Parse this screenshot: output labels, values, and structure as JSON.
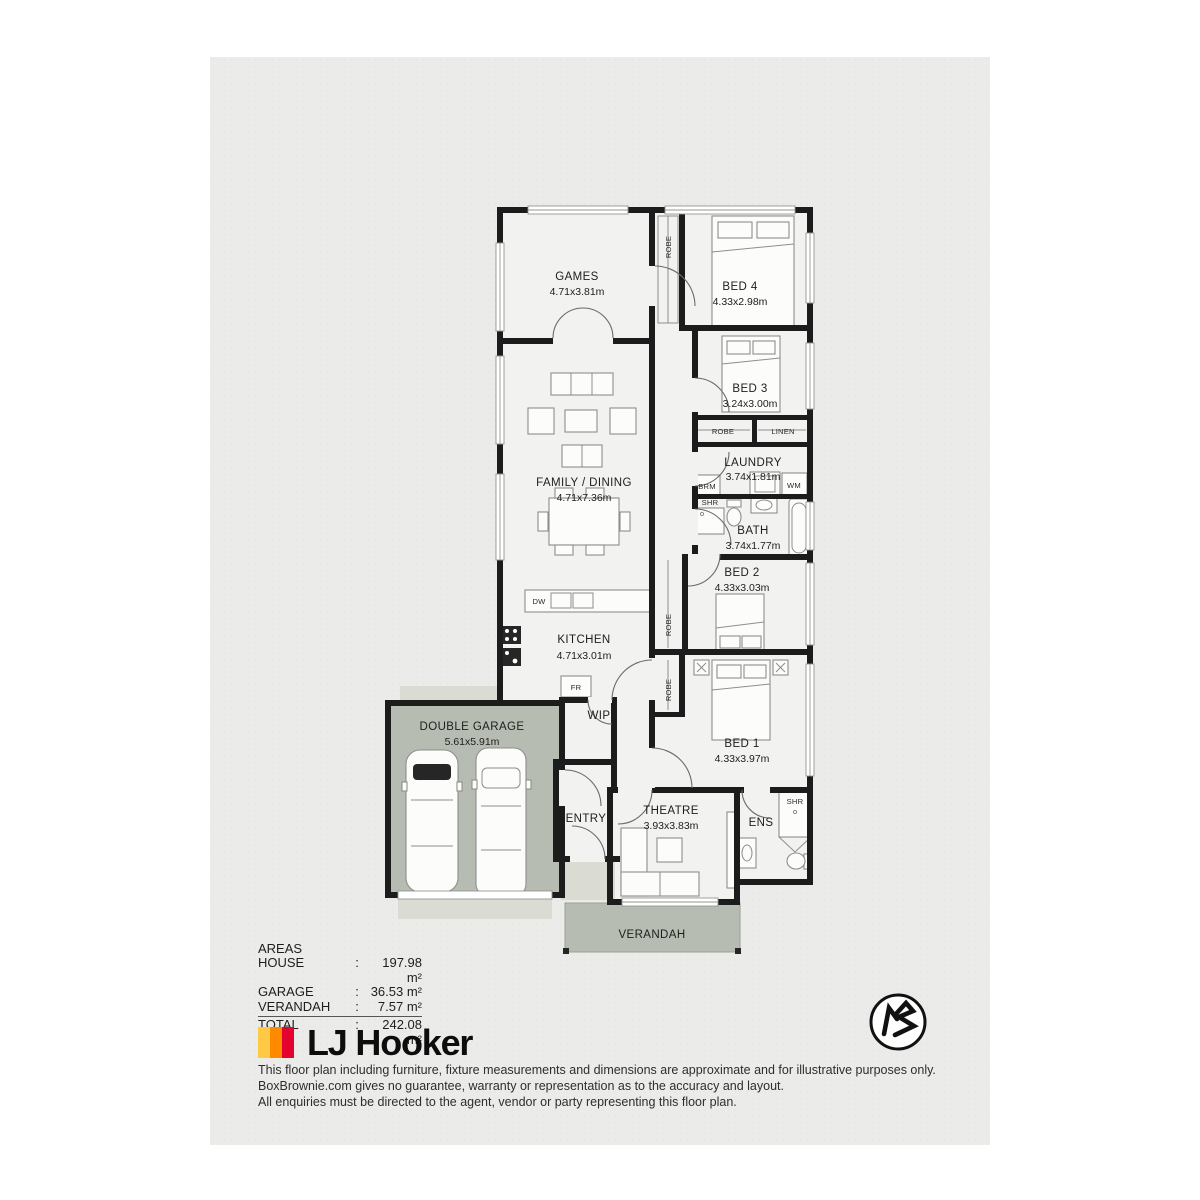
{
  "plan": {
    "rooms": {
      "games": {
        "name": "GAMES",
        "dims": "4.71x3.81m"
      },
      "bed4": {
        "name": "BED 4",
        "dims": "4.33x2.98m"
      },
      "bed3": {
        "name": "BED 3",
        "dims": "3.24x3.00m"
      },
      "laundry": {
        "name": "LAUNDRY",
        "dims": "3.74x1.81m"
      },
      "bath": {
        "name": "BATH",
        "dims": "3.74x1.77m"
      },
      "family_dining": {
        "name": "FAMILY / DINING",
        "dims": "4.71x7.36m"
      },
      "bed2": {
        "name": "BED 2",
        "dims": "4.33x3.03m"
      },
      "kitchen": {
        "name": "KITCHEN",
        "dims": "4.71x3.01m"
      },
      "bed1": {
        "name": "BED 1",
        "dims": "4.33x3.97m"
      },
      "garage": {
        "name": "DOUBLE GARAGE",
        "dims": "5.61x5.91m"
      },
      "theatre": {
        "name": "THEATRE",
        "dims": "3.93x3.83m"
      },
      "entry": {
        "name": "ENTRY"
      },
      "ens": {
        "name": "ENS"
      },
      "wip": {
        "name": "WIP"
      },
      "verandah": {
        "name": "VERANDAH"
      }
    },
    "fixtures": {
      "robe": "ROBE",
      "linen": "LINEN",
      "brm": "BRM",
      "shr": "SHR",
      "wm": "WM",
      "dw": "DW",
      "fr": "FR"
    }
  },
  "areas": {
    "title": "AREAS",
    "separator": ":",
    "rows": [
      {
        "label": "HOUSE",
        "value": "197.98 m²"
      },
      {
        "label": "GARAGE",
        "value": "36.53 m²"
      },
      {
        "label": "VERANDAH",
        "value": "7.57 m²"
      }
    ],
    "total": {
      "label": "TOTAL",
      "value": "242.08 m²"
    }
  },
  "branding": {
    "agency_name": "LJ Hooker",
    "stripe_colors": [
      "#FFC845",
      "#FF8A00",
      "#E4032E"
    ]
  },
  "disclaimer": {
    "line1": "This floor plan including furniture, fixture measurements and dimensions are approximate and for illustrative purposes only.",
    "line2": "BoxBrownie.com gives no guarantee, warranty or representation as to the accuracy and layout.",
    "line3": "All enquiries must be directed to the agent, vendor or party representing this floor plan."
  },
  "colors": {
    "page_background": "#ebebe9",
    "room_fill": "#f2f2f0",
    "garage_fill": "#b6bcb2",
    "wall": "#1c1c1c"
  }
}
